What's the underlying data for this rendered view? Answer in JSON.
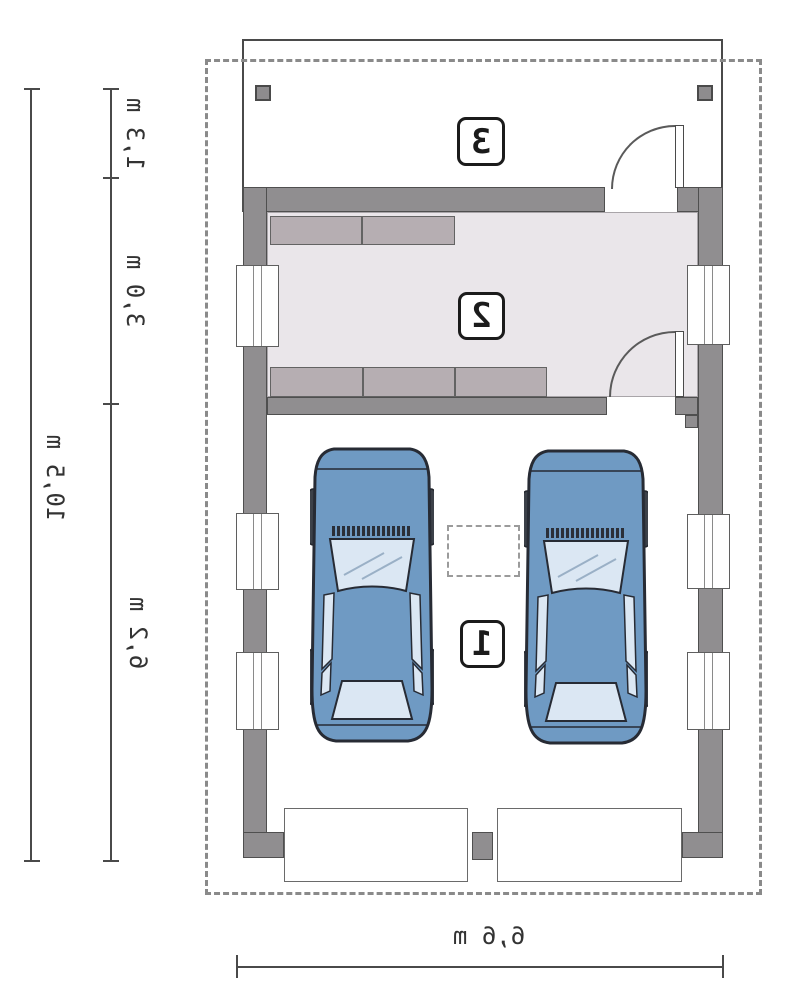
{
  "dimensions": {
    "left_outer": "10,5 m",
    "left_seg_top": "1,3 m",
    "left_seg_mid": "3,0 m",
    "left_seg_bottom": "6,2 m",
    "bottom_width": "6,6 m"
  },
  "rooms": {
    "garage": "1",
    "utility": "2",
    "porch": "3"
  },
  "colors": {
    "wall": "#908e90",
    "floor_room2": "#eae6ea",
    "counter": "#b6aeb2",
    "car_body": "#6f9ac3",
    "car_glass": "#dbe7f3",
    "outline": "#4a4a4a",
    "dashed": "#8a8a8a",
    "text": "#333333"
  }
}
